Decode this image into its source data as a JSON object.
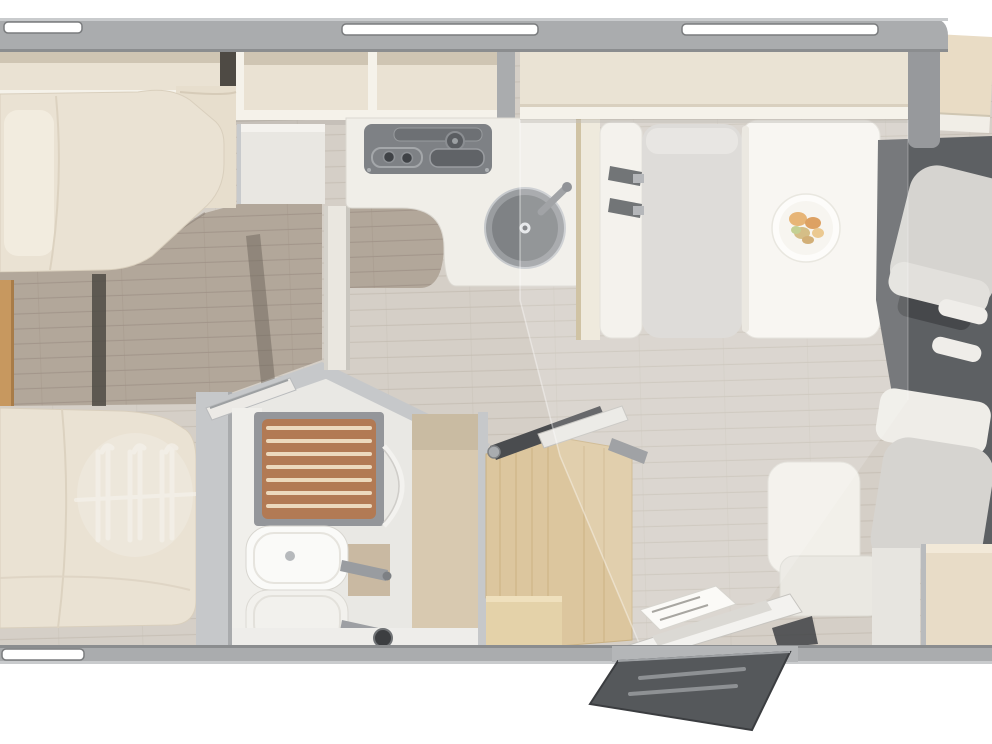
{
  "meta": {
    "description": "Top-down 3D rendered floor plan of a motorhome interior, rear (left) to cab (right)",
    "visible_text": "none",
    "window_count": 4
  },
  "palette": {
    "bg": "#ffffff",
    "wall": "#aaacae",
    "wallEdge": "#8b8d8f",
    "wallHighlight": "#c9cbcd",
    "windowFill": "#ffffff",
    "floorMain": "#d5cfc7",
    "floorMainLine": "#c3bbb0",
    "floorRear": "#b2a79a",
    "floorRearLine": "#9f9287",
    "cabFloor": "#5d6063",
    "cream": "#eae2d3",
    "creamLip": "#f5f2ea",
    "cabinetShade": "#cfc5b3",
    "darkSlot": "#4e4a44",
    "counter": "#f0eee8",
    "cooktop": "#7e8185",
    "sink": "#9a9da0",
    "sinkInner": "#7f8285",
    "teak": "#b27a54",
    "teakSlat": "#ecd9bd",
    "bathWall": "#c6c8ca",
    "basin": "#fafaf8",
    "tanBench": "#d8c9b0",
    "woodStep": "#dcc69e",
    "woodLadder": "#c7985f",
    "benchCushion": "#d8d6d2",
    "seatWhite": "#f2f0ea",
    "table": "#f7f5f0",
    "plate": "#fdfcf9",
    "dropBed": "#eae3d4",
    "dropBedFrame": "#97999c",
    "dashboard": "#e9dcc5",
    "dashboardTrim": "#f1eee7",
    "belt": "#585b5e",
    "doorStep": "#55585b",
    "stepTread": "#8e9194",
    "entryBox": "#e8dcc7",
    "metal": "#9da0a3"
  },
  "scene": {
    "rooms": [
      "rear-bedroom-with-twin-single-beds",
      "washroom-with-shower-and-basin",
      "kitchen-with-cooktop-and-round-sink",
      "half-dinette-with-table-and-belted-bench",
      "entrance-with-fold-out-step",
      "cab-with-two-swivel-seats"
    ],
    "furniture": [
      "overhead-cabinets",
      "single-bed-top",
      "single-bed-bottom",
      "wardrobe-hangers",
      "bed-ladder",
      "shower-teak-grate",
      "washbasin",
      "washbasin-reflection",
      "bathroom-door",
      "tv-on-bracket",
      "wood-step-cabinet",
      "kitchen-counter",
      "cooktop",
      "round-sink",
      "drop-down-bed",
      "dinette-bench",
      "seat-belts",
      "dinette-table",
      "plate-of-food",
      "single-side-seat",
      "driver-swivel-seat",
      "passenger-swivel-seat",
      "dashboard",
      "entry-door",
      "entry-step"
    ]
  }
}
